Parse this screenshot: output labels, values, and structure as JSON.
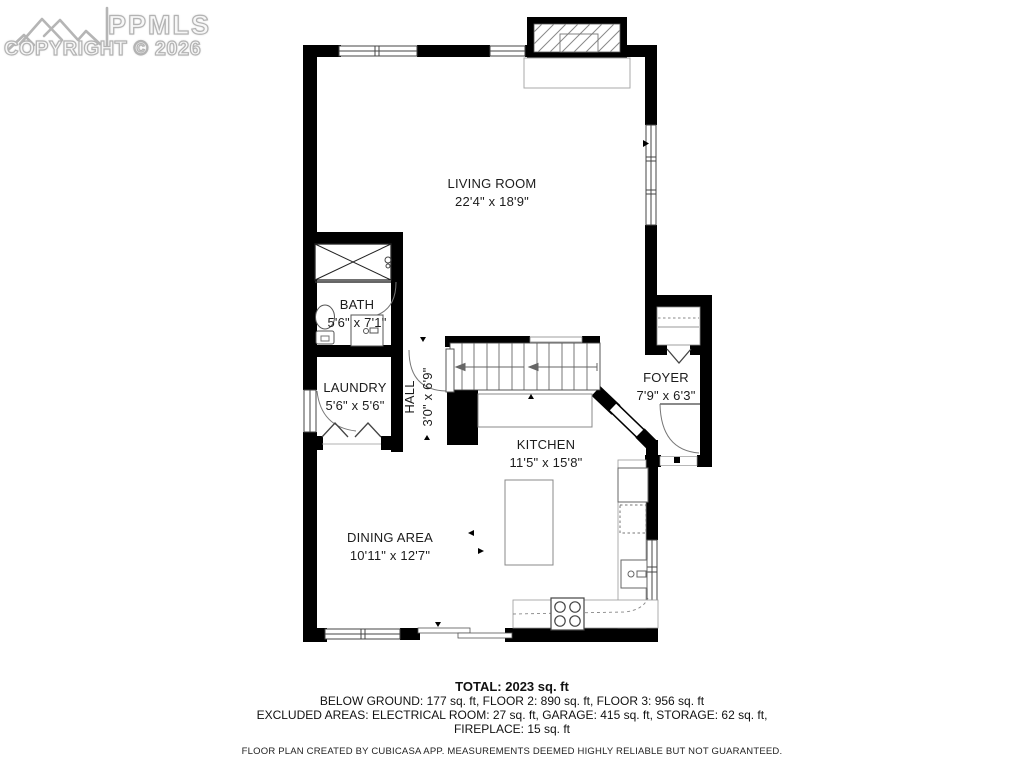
{
  "watermark": {
    "logo_text": "PPMLS",
    "copyright": "COPYRIGHT © 2026"
  },
  "rooms": [
    {
      "name": "LIVING ROOM",
      "dims": "22'4\" x 18'9\""
    },
    {
      "name": "BATH",
      "dims": "5'6\" x 7'1\""
    },
    {
      "name": "LAUNDRY",
      "dims": "5'6\" x 5'6\""
    },
    {
      "name": "HALL",
      "dims": "3'0\" x 6'9\""
    },
    {
      "name": "FOYER",
      "dims": "7'9\" x 6'3\""
    },
    {
      "name": "KITCHEN",
      "dims": "11'5\" x 15'8\""
    },
    {
      "name": "DINING AREA",
      "dims": "10'11\" x 12'7\""
    }
  ],
  "summary": {
    "total": "TOTAL: 2023 sq. ft",
    "line1": "BELOW GROUND: 177 sq. ft, FLOOR 2: 890 sq. ft, FLOOR 3: 956 sq. ft",
    "line2": "EXCLUDED AREAS: ELECTRICAL ROOM: 27 sq. ft, GARAGE: 415 sq. ft, STORAGE: 62 sq. ft,",
    "line3": "FIREPLACE: 15 sq. ft",
    "disclaimer": "FLOOR PLAN CREATED BY CUBICASA APP. MEASUREMENTS DEEMED HIGHLY RELIABLE BUT NOT GUARANTEED."
  },
  "colors": {
    "wall": "#000000",
    "watermark_gray": "#b3b3b3",
    "background": "#ffffff",
    "label_text": "#1c1c1c"
  }
}
